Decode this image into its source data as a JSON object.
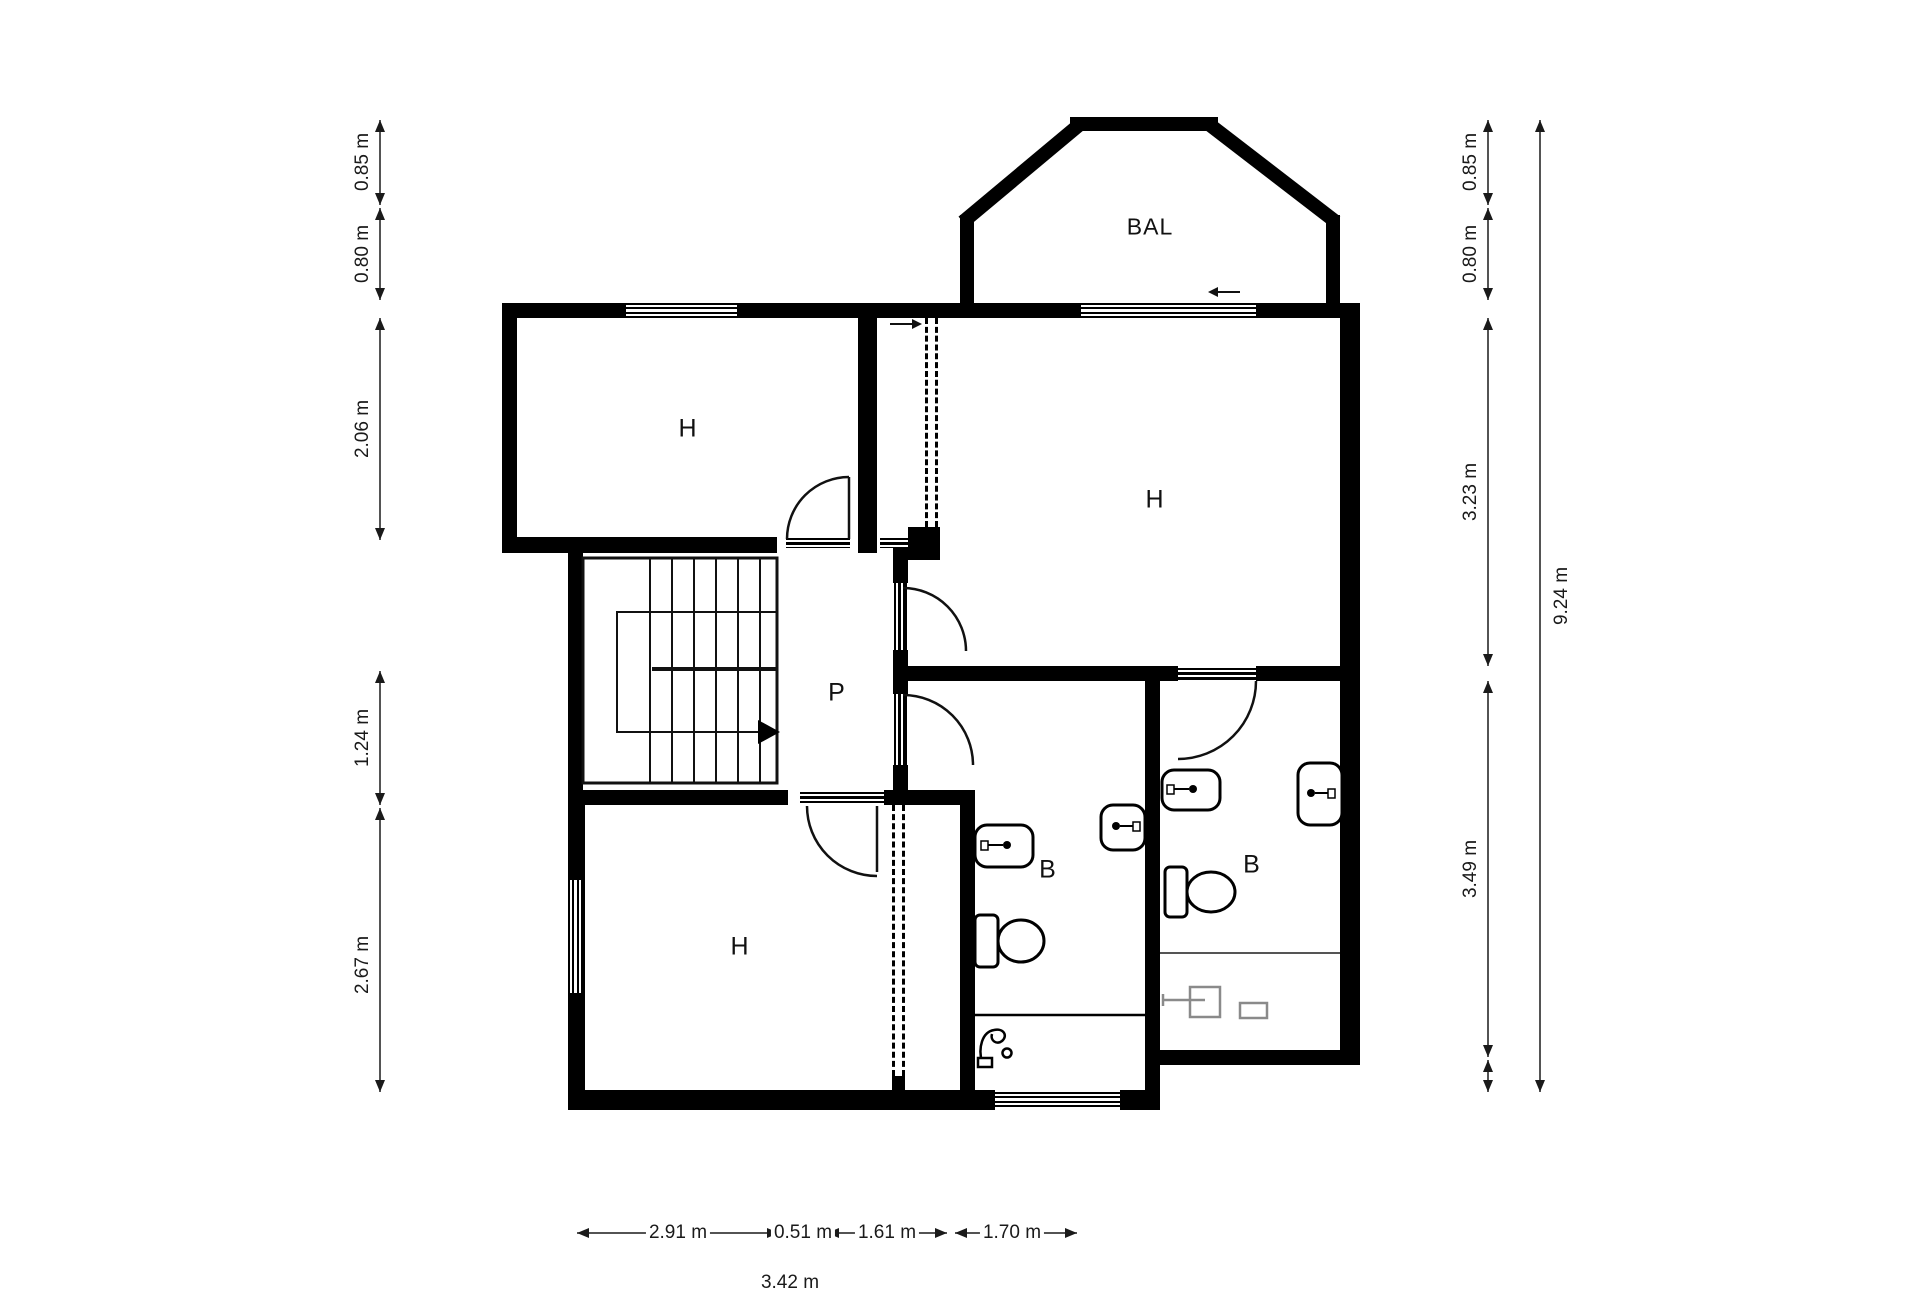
{
  "plan": {
    "rooms": [
      {
        "id": "bedroom-top-left",
        "label": "H"
      },
      {
        "id": "bedroom-right",
        "label": "H"
      },
      {
        "id": "bedroom-bottom",
        "label": "H"
      },
      {
        "id": "hallway",
        "label": "P"
      },
      {
        "id": "bathroom-left",
        "label": "B"
      },
      {
        "id": "bathroom-right",
        "label": "B"
      },
      {
        "id": "balcony",
        "label": "BAL"
      }
    ]
  },
  "dimensions": {
    "left": [
      "0.85 m",
      "0.80 m",
      "2.06 m",
      "1.24 m",
      "2.67 m"
    ],
    "right_inner": [
      "0.85 m",
      "0.80 m",
      "3.23 m",
      "3.49 m"
    ],
    "right_overall": "9.24 m",
    "bottom": [
      "2.91 m",
      "0.51 m",
      "1.61 m",
      "1.70 m"
    ],
    "top_truncated": [
      "3.43 m",
      "0.51 m",
      "0.94 m",
      "1.61 m"
    ],
    "bottom_truncated": "3.42 m"
  },
  "colors": {
    "wall": "#000000",
    "dimension": "#1a1a1a",
    "fixture_gray": "#8a8a8a",
    "background": "#ffffff"
  }
}
